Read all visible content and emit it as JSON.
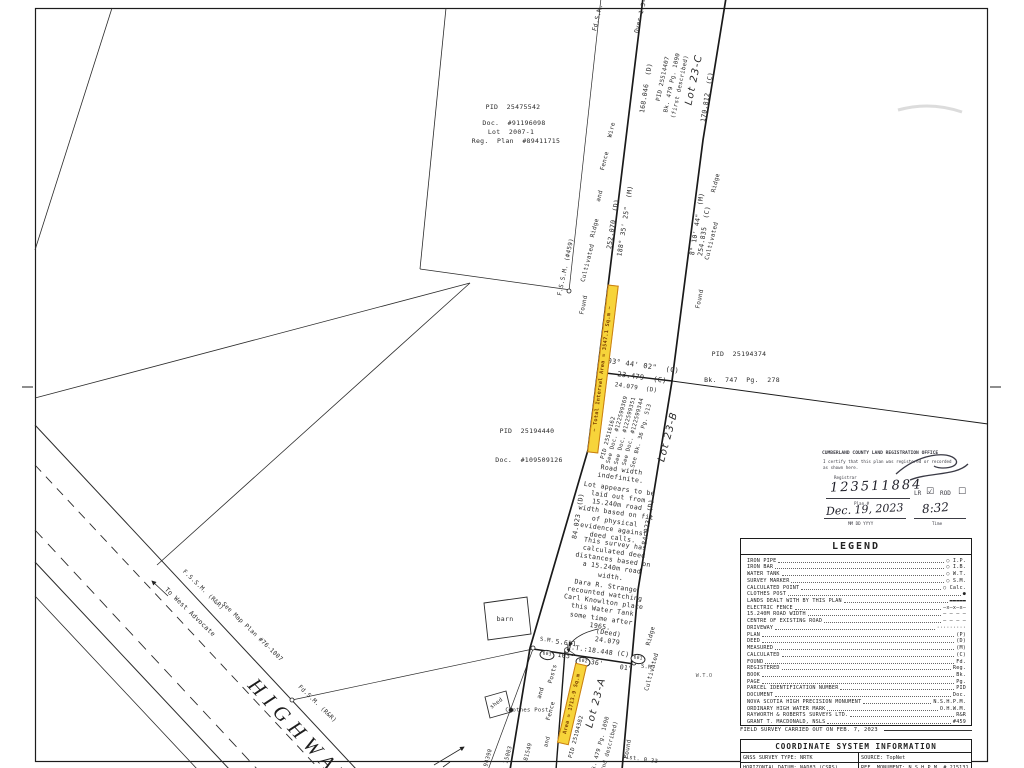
{
  "colors": {
    "ink": "#1c1c1c",
    "highlight_fill": "#f7d43a",
    "highlight_border": "#c97e14",
    "highlight_text": "#7c3e00",
    "stamp_ink": "#3c3c44"
  },
  "map": {
    "labels": [
      {
        "k": "fdsm-top-label",
        "t": "Fd.S.M. (",
        "x": 599,
        "y": 14,
        "r": -76,
        "s": 6
      },
      {
        "k": "over-dist-label",
        "t": "Over 1.5-",
        "x": 641,
        "y": 16,
        "r": -76,
        "s": 6
      },
      {
        "k": "dist-168-046",
        "t": "168.046  (D)",
        "x": 646,
        "y": 88,
        "r": -81,
        "s": 6.5
      },
      {
        "k": "pid-25514407",
        "t": "PID 25514407",
        "x": 664,
        "y": 79,
        "r": -78,
        "s": 5.8
      },
      {
        "k": "bk-479-pg-1090-first",
        "t": "Bk. 479 Pg. 1090",
        "x": 673,
        "y": 83,
        "r": -78,
        "s": 5.8
      },
      {
        "k": "first-described",
        "t": "(first described)",
        "x": 681,
        "y": 87,
        "r": -78,
        "s": 5.8
      },
      {
        "k": "lot-23c",
        "t": "Lot 23-C",
        "x": 695,
        "y": 80,
        "r": -78,
        "s": 10,
        "c": "lot"
      },
      {
        "k": "dist-170-812",
        "t": "170.812  (C)",
        "x": 707,
        "y": 97,
        "r": -81,
        "s": 6.5
      },
      {
        "k": "wire-label",
        "t": "Wire",
        "x": 612,
        "y": 130,
        "r": -76,
        "s": 6
      },
      {
        "k": "fence-upper-label",
        "t": "Fence",
        "x": 605,
        "y": 161,
        "r": -76,
        "s": 6
      },
      {
        "k": "and-upper-label",
        "t": "and",
        "x": 600,
        "y": 196,
        "r": -76,
        "s": 6
      },
      {
        "k": "ridge-upper-label",
        "t": "Ridge",
        "x": 595,
        "y": 228,
        "r": -76,
        "s": 6
      },
      {
        "k": "cultivated-upper-label",
        "t": "Cultivated",
        "x": 588,
        "y": 263,
        "r": -76,
        "s": 6
      },
      {
        "k": "dist-252-070",
        "t": "252.070  (D)",
        "x": 613,
        "y": 224,
        "r": -81,
        "s": 6.5
      },
      {
        "k": "bearing-188-35-25",
        "t": "188° 35' 25\"  (M)",
        "x": 625,
        "y": 221,
        "r": -81,
        "s": 6.5
      },
      {
        "k": "ridge-right-label",
        "t": "Ridge",
        "x": 716,
        "y": 183,
        "r": -76,
        "s": 6
      },
      {
        "k": "bearing-8-10-44",
        "t": "8° 10' 44\"  (M)",
        "x": 697,
        "y": 224,
        "r": -81,
        "s": 6.5
      },
      {
        "k": "dist-254-835",
        "t": "254.835  (C)",
        "x": 704,
        "y": 231,
        "r": -81,
        "s": 6.5
      },
      {
        "k": "cultivated-right-label",
        "t": "Cultivated",
        "x": 712,
        "y": 241,
        "r": -76,
        "s": 6
      },
      {
        "k": "found-right-label",
        "t": "Found",
        "x": 700,
        "y": 299,
        "r": -78,
        "s": 6
      },
      {
        "k": "found-left-label",
        "t": "Found",
        "x": 584,
        "y": 305,
        "r": -78,
        "s": 6
      },
      {
        "k": "fssm-459-label",
        "t": "F.S.S.M. (#459)",
        "x": 566,
        "y": 267,
        "r": -78,
        "s": 6
      },
      {
        "k": "pid-25194374",
        "t": "PID  25194374",
        "x": 739,
        "y": 354,
        "r": 0,
        "s": 6.5
      },
      {
        "k": "bk-747-pg-278",
        "t": "Bk.  747  Pg.  278",
        "x": 742,
        "y": 380,
        "r": 0,
        "s": 6.5
      },
      {
        "k": "bearing-103-44-02",
        "t": "103° 44' 02\"  (C)",
        "x": 641,
        "y": 366,
        "r": 8,
        "s": 7
      },
      {
        "k": "dist-23-479",
        "t": "23.479  (C)",
        "x": 642,
        "y": 378,
        "r": 8,
        "s": 7
      },
      {
        "k": "dist-24-079-d",
        "t": "24.079  (D)",
        "x": 636,
        "y": 388,
        "r": 8,
        "s": 6
      },
      {
        "k": "highlight-total-interval-area",
        "t": "~ Total Interval Area = 3547.1 Sq.m ~",
        "x": 603,
        "y": 369,
        "r": -83,
        "s": 5.2,
        "c": "hl",
        "w": 167,
        "h": 9
      },
      {
        "k": "pid-25516162",
        "t": "PID 25516162",
        "x": 609,
        "y": 438,
        "r": -75,
        "s": 5.6
      },
      {
        "k": "see-doc-122599369",
        "t": "See Doc. #122599369",
        "x": 618,
        "y": 430,
        "r": -75,
        "s": 5.6
      },
      {
        "k": "see-doc-122599351",
        "t": "See Doc. #122599351",
        "x": 626,
        "y": 431,
        "r": -75,
        "s": 5.6
      },
      {
        "k": "see-doc-122599344",
        "t": "See Doc. #122599344",
        "x": 634,
        "y": 432,
        "r": -75,
        "s": 5.6
      },
      {
        "k": "see-bk-36-pg-513",
        "t": "See Bk. 36 Pg. 513",
        "x": 642,
        "y": 436,
        "r": -75,
        "s": 5.6
      },
      {
        "k": "lot-23b",
        "t": "Lot 23-B",
        "x": 669,
        "y": 437,
        "r": -75,
        "s": 10,
        "c": "lot"
      },
      {
        "k": "dist-84-023-west",
        "t": "84.023  (D)",
        "x": 578,
        "y": 516,
        "r": -81,
        "s": 6.5
      },
      {
        "k": "dist-84-023-east",
        "t": "84.023  (D)",
        "x": 648,
        "y": 522,
        "r": -81,
        "s": 6.5
      },
      {
        "k": "note-road-width",
        "t": "Road width\nindefinite.",
        "x": 621,
        "y": 474,
        "r": 8,
        "s": 6.5,
        "c": "note"
      },
      {
        "k": "note-lot-appears",
        "t": "Lot appears to be\nlaid out from\n15.240m road\nwidth based on fit\nof physical\nevidence against\ndeed calls.",
        "x": 616,
        "y": 513,
        "r": 8,
        "s": 6.5,
        "c": "note"
      },
      {
        "k": "note-survey-calculated",
        "t": "This survey has\ncalculated deed\ndistances based on\na 15.240m road\nwidth.",
        "x": 613,
        "y": 560,
        "r": 8,
        "s": 6.5,
        "c": "note"
      },
      {
        "k": "note-dara-strange",
        "t": "Dara R. Strange\nrecounted watching\nCarl Knowlton place\nthis Water Tank\nsome time after\n1965.",
        "x": 603,
        "y": 606,
        "r": 8,
        "s": 6.5,
        "c": "note"
      },
      {
        "k": "sm-left-label",
        "t": "S.M.",
        "x": 547,
        "y": 641,
        "r": 8,
        "s": 5.5
      },
      {
        "k": "dist-5-631",
        "t": "5.631",
        "x": 566,
        "y": 643,
        "r": 8,
        "s": 6.5
      },
      {
        "k": "deed-24-079",
        "t": "(Deed)\n24.079",
        "x": 608,
        "y": 637,
        "r": 8,
        "s": 6.5,
        "c": "note"
      },
      {
        "k": "wt-18-448",
        "t": "W.T.:18.448",
        "x": 590,
        "y": 650,
        "r": 8,
        "s": 6.5
      },
      {
        "k": "c-mark-crossline2",
        "t": "(C)",
        "x": 623,
        "y": 654,
        "r": 8,
        "s": 6.5
      },
      {
        "k": "deg-103",
        "t": "103°",
        "x": 566,
        "y": 656,
        "r": 8,
        "s": 6.5
      },
      {
        "k": "min-36",
        "t": "36'",
        "x": 597,
        "y": 663,
        "r": 8,
        "s": 6.5
      },
      {
        "k": "sec-01",
        "t": "01\"",
        "x": 626,
        "y": 668,
        "r": 8,
        "s": 6.5
      },
      {
        "k": "sm-right-label",
        "t": "S.M.",
        "x": 648,
        "y": 668,
        "r": 8,
        "s": 5.5
      },
      {
        "k": "point-603",
        "t": "603",
        "x": 547,
        "y": 655,
        "r": 8,
        "s": 4.5,
        "c": "ptcircle"
      },
      {
        "k": "point-602",
        "t": "602",
        "x": 583,
        "y": 662,
        "r": 8,
        "s": 4.5,
        "c": "ptcircle"
      },
      {
        "k": "point-601",
        "t": "601",
        "x": 638,
        "y": 659,
        "r": 8,
        "s": 4.5,
        "c": "ptcircle"
      },
      {
        "k": "posts-label",
        "t": "Posts",
        "x": 553,
        "y": 674,
        "r": -75,
        "s": 6
      },
      {
        "k": "and-mid-label",
        "t": "and",
        "x": 541,
        "y": 693,
        "r": -75,
        "s": 6
      },
      {
        "k": "fence-lower-label",
        "t": "Fence",
        "x": 551,
        "y": 711,
        "r": -75,
        "s": 6
      },
      {
        "k": "cultivated-bottom-label",
        "t": "Cultivated",
        "x": 652,
        "y": 672,
        "r": -75,
        "s": 6
      },
      {
        "k": "ridge-bottom-label",
        "t": "Ridge",
        "x": 651,
        "y": 636,
        "r": -75,
        "s": 6
      },
      {
        "k": "found-bottom-label",
        "t": "Found",
        "x": 628,
        "y": 749,
        "r": -80,
        "s": 6
      },
      {
        "k": "dist-0-33",
        "t": "Dist. 0.33",
        "x": 640,
        "y": 760,
        "r": 8,
        "s": 5.5
      },
      {
        "k": "lot-23a",
        "t": "Lot 23-A",
        "x": 597,
        "y": 703,
        "r": -75,
        "s": 10,
        "c": "lot"
      },
      {
        "k": "highlight-area-1713",
        "t": "Area = 1713.9 Sq.m",
        "x": 572,
        "y": 704,
        "r": -77,
        "s": 5.2,
        "c": "hl",
        "w": 80,
        "h": 10
      },
      {
        "k": "pid-25194382",
        "t": "PID 25194382",
        "x": 577,
        "y": 737,
        "r": -75,
        "s": 5.6
      },
      {
        "k": "bk-479-pg-1090-second",
        "t": "Bk. 479 Pg. 1090",
        "x": 601,
        "y": 745,
        "r": -75,
        "s": 5.6
      },
      {
        "k": "second-described",
        "t": "(2nd described)",
        "x": 610,
        "y": 748,
        "r": -75,
        "s": 5.6
      },
      {
        "k": "fragment-94390",
        "t": "94390",
        "x": 489,
        "y": 758,
        "r": -75,
        "s": 5.6
      },
      {
        "k": "fragment-15003",
        "t": "15003",
        "x": 509,
        "y": 755,
        "r": -75,
        "s": 5.6
      },
      {
        "k": "fragment-81549",
        "t": "81549",
        "x": 529,
        "y": 752,
        "r": -75,
        "s": 5.6
      },
      {
        "k": "and-bottom-label",
        "t": "and",
        "x": 548,
        "y": 742,
        "r": -75,
        "s": 5.6
      },
      {
        "k": "clothes-post-label",
        "t": "Clothes Post",
        "x": 527,
        "y": 711,
        "r": 0,
        "s": 5.5
      },
      {
        "k": "shed-label",
        "t": "shed",
        "x": 497,
        "y": 704,
        "r": -38,
        "s": 5.5
      },
      {
        "k": "barn-label",
        "t": "barn",
        "x": 505,
        "y": 619,
        "r": 0,
        "s": 6.5
      },
      {
        "k": "fssm-rr-upper-label",
        "t": "F.S.S.M. (R&R)",
        "x": 203,
        "y": 590,
        "r": 44,
        "s": 6
      },
      {
        "k": "see-map-plan",
        "t": "See Map Plan #76-1007",
        "x": 252,
        "y": 632,
        "r": 44,
        "s": 6
      },
      {
        "k": "to-west-advocate",
        "t": "To West Advocate",
        "x": 190,
        "y": 612,
        "r": 44,
        "s": 6.5
      },
      {
        "k": "fdsm-rr-lower-label",
        "t": "Fd.S.M. (R&R)",
        "x": 317,
        "y": 704,
        "r": 44,
        "s": 6
      },
      {
        "k": "highway-name",
        "t": "HIGHWAY",
        "x": 300,
        "y": 733,
        "r": 47,
        "s": 21,
        "c": "hw"
      },
      {
        "k": "water-tank-symbol-label",
        "t": "W.T.O",
        "x": 704,
        "y": 676,
        "r": 0,
        "s": 5,
        "c": "tinygray"
      },
      {
        "k": "pid-25475542",
        "t": "PID  25475542",
        "x": 513,
        "y": 107,
        "r": 0,
        "s": 6.5
      },
      {
        "k": "doc-91196098",
        "t": "Doc.  #91196098",
        "x": 514,
        "y": 123,
        "r": 0,
        "s": 6.5
      },
      {
        "k": "lot-2007-1",
        "t": "Lot  2007-1",
        "x": 511,
        "y": 132,
        "r": 0,
        "s": 6.5
      },
      {
        "k": "reg-plan-89411715",
        "t": "Reg.  Plan  #89411715",
        "x": 516,
        "y": 141,
        "r": 0,
        "s": 6.5
      },
      {
        "k": "pid-25194440",
        "t": "PID  25194440",
        "x": 527,
        "y": 431,
        "r": 0,
        "s": 6.5
      },
      {
        "k": "doc-109509126",
        "t": "Doc.  #109509126",
        "x": 529,
        "y": 460,
        "r": 0,
        "s": 6.5
      }
    ]
  },
  "stamp": {
    "office": "CUMBERLAND COUNTY LAND REGISTRATION OFFICE",
    "certify_line1": "I certify that this plan was registered or recorded",
    "certify_line2": "as shown here.",
    "registrar_label": "Registrar",
    "plan_number": "123511884",
    "plan_label": "Plan #",
    "lr_label": "LR",
    "lr_checkbox": "☑",
    "rod_label": "ROD",
    "rod_checkbox": "☐",
    "date_value": "Dec. 19, 2023",
    "date_label": "MM   DD   YYYY",
    "time_value": "8:32",
    "time_label": "Time"
  },
  "legend": {
    "title": "LEGEND",
    "items": [
      {
        "label": "IRON PIPE",
        "symbol": "○ I.P."
      },
      {
        "label": "IRON BAR",
        "symbol": "○ I.B."
      },
      {
        "label": "WATER TANK",
        "symbol": "○ W.T."
      },
      {
        "label": "SURVEY MARKER",
        "symbol": "○ S.M."
      },
      {
        "label": "CALCULATED POINT",
        "symbol": "○ Calc."
      },
      {
        "label": "CLOTHES POST",
        "symbol": "●"
      },
      {
        "label": "LANDS DEALT WITH BY THIS PLAN",
        "symbol": "▬▬▬▬▬"
      },
      {
        "label": "ELECTRIC FENCE",
        "symbol": "—x—x—x—"
      },
      {
        "label": "15.240M ROAD WIDTH",
        "symbol": "— — — —"
      },
      {
        "label": "CENTRE OF EXISTING ROAD",
        "symbol": "— – — –"
      },
      {
        "label": "DRIVEWAY",
        "symbol": "·········"
      },
      {
        "label": "PLAN",
        "symbol": "(P)"
      },
      {
        "label": "DEED",
        "symbol": "(D)"
      },
      {
        "label": "MEASURED",
        "symbol": "(M)"
      },
      {
        "label": "CALCULATED",
        "symbol": "(C)"
      },
      {
        "label": "FOUND",
        "symbol": "Fd."
      },
      {
        "label": "REGISTERED",
        "symbol": "Reg."
      },
      {
        "label": "BOOK",
        "symbol": "Bk."
      },
      {
        "label": "PAGE",
        "symbol": "Pg."
      },
      {
        "label": "PARCEL IDENTIFICATION NUMBER",
        "symbol": "PID"
      },
      {
        "label": "DOCUMENT",
        "symbol": "Doc."
      },
      {
        "label": "NOVA SCOTIA HIGH PRECISION MONUMENT",
        "symbol": "N.S.H.P.M."
      },
      {
        "label": "ORDINARY HIGH WATER MARK",
        "symbol": "O.H.W.M."
      },
      {
        "label": "RAYWORTH & ROBERTS SURVEYS LTD.",
        "symbol": "R&R"
      },
      {
        "label": "GRANT T. MACDONALD, NSLS",
        "symbol": "#459"
      }
    ]
  },
  "field_survey_note": "FIELD SURVEY CARRIED OUT ON FEB. 7, 2023",
  "coordinate_table": {
    "title": "COORDINATE SYSTEM INFORMATION",
    "r1c1": "GNSS SURVEY TYPE: NRTK",
    "r1c2": "SOURCE: TopNet",
    "r2c1": "HORIZONTAL DATUM: NAD83 (CSRS)",
    "r2c2": "REF. MONUMENT: N.S.H.P.M. # 215131",
    "r3c1": "VERTICAL DATUM: CGVD2013",
    "r3c2": "N  5020956.643m",
    "r3c3": "EPOCH: 2010.0 V6"
  }
}
